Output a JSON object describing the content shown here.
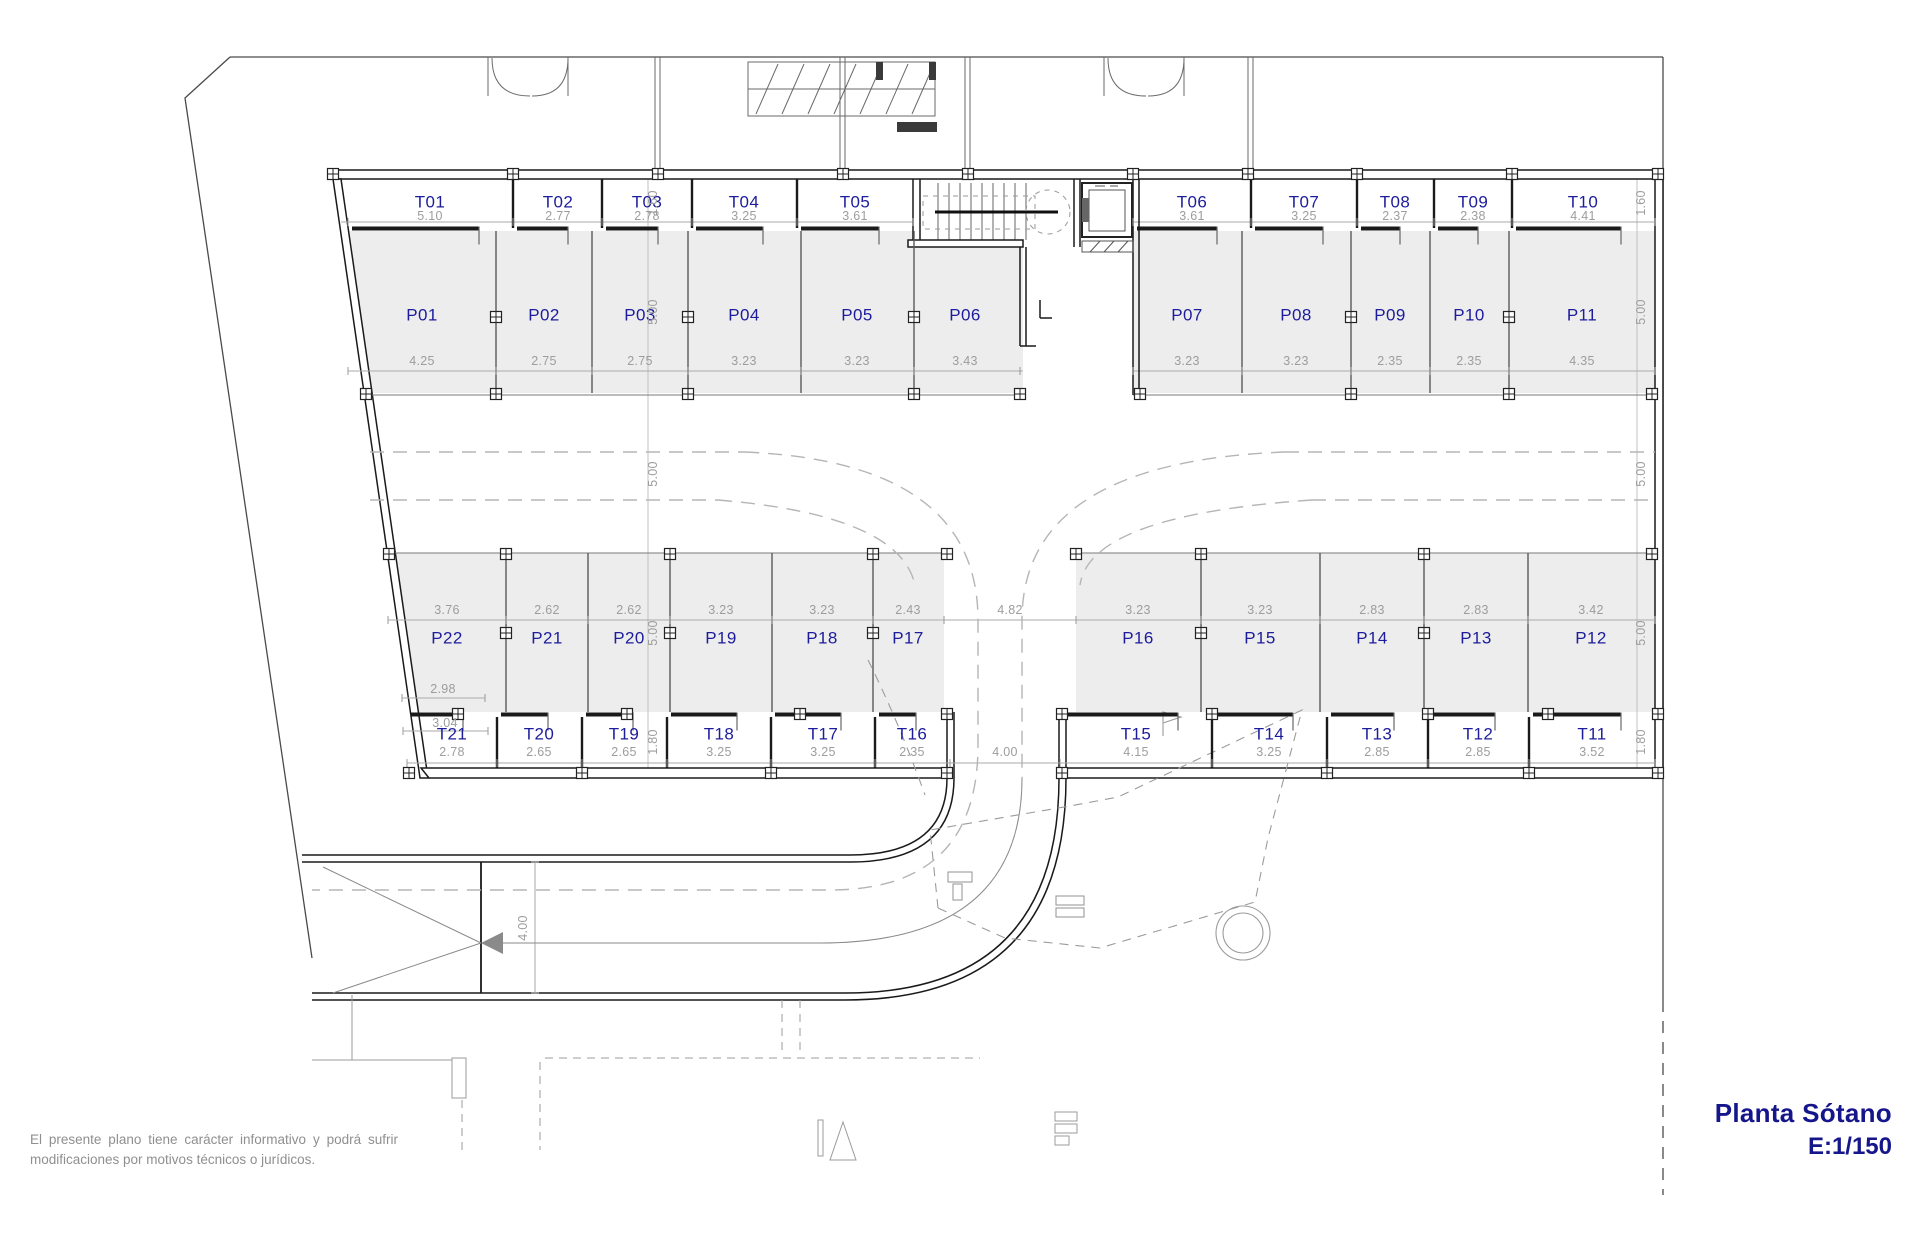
{
  "page": {
    "title": "Planta Sótano",
    "scale": "E:1/150"
  },
  "disclaimer": {
    "line1": "El presente plano tiene carácter informativo y podrá sufrir",
    "line2": "modificaciones por motivos técnicos o jurídicos."
  },
  "colors": {
    "room_label": "#1c1c9c",
    "dim_label": "#9d9d9d",
    "title": "#16168c",
    "stall_fill": "#ededed",
    "wall": "#1a1a1a"
  },
  "rooms": [
    {
      "group": "storage-top",
      "label_y": 202,
      "dim_y": 216,
      "items": [
        {
          "id": "T01",
          "dim": "5.10",
          "cx": 430
        },
        {
          "id": "T02",
          "dim": "2.77",
          "cx": 558
        },
        {
          "id": "T03",
          "dim": "2.78",
          "cx": 647
        },
        {
          "id": "T04",
          "dim": "3.25",
          "cx": 744
        },
        {
          "id": "T05",
          "dim": "3.61",
          "cx": 855
        },
        {
          "id": "T06",
          "dim": "3.61",
          "cx": 1192
        },
        {
          "id": "T07",
          "dim": "3.25",
          "cx": 1304
        },
        {
          "id": "T08",
          "dim": "2.37",
          "cx": 1395
        },
        {
          "id": "T09",
          "dim": "2.38",
          "cx": 1473
        },
        {
          "id": "T10",
          "dim": "4.41",
          "cx": 1583
        }
      ]
    },
    {
      "group": "parking-top",
      "label_y": 315,
      "dim_y": 361,
      "items": [
        {
          "id": "P01",
          "dim": "4.25",
          "cx": 422
        },
        {
          "id": "P02",
          "dim": "2.75",
          "cx": 544
        },
        {
          "id": "P03",
          "dim": "2.75",
          "cx": 640
        },
        {
          "id": "P04",
          "dim": "3.23",
          "cx": 744
        },
        {
          "id": "P05",
          "dim": "3.23",
          "cx": 857
        },
        {
          "id": "P06",
          "dim": "3.43",
          "cx": 965
        },
        {
          "id": "P07",
          "dim": "3.23",
          "cx": 1187
        },
        {
          "id": "P08",
          "dim": "3.23",
          "cx": 1296
        },
        {
          "id": "P09",
          "dim": "2.35",
          "cx": 1390
        },
        {
          "id": "P10",
          "dim": "2.35",
          "cx": 1469
        },
        {
          "id": "P11",
          "dim": "4.35",
          "cx": 1582
        }
      ]
    },
    {
      "group": "parking-bottom",
      "label_y": 638,
      "dim_y": 610,
      "items": [
        {
          "id": "P22",
          "dim": "3.76",
          "cx": 447
        },
        {
          "id": "P21",
          "dim": "2.62",
          "cx": 547
        },
        {
          "id": "P20",
          "dim": "2.62",
          "cx": 629
        },
        {
          "id": "P19",
          "dim": "3.23",
          "cx": 721
        },
        {
          "id": "P18",
          "dim": "3.23",
          "cx": 822
        },
        {
          "id": "P17",
          "dim": "2.43",
          "cx": 908
        },
        {
          "id": "P16",
          "dim": "3.23",
          "cx": 1138
        },
        {
          "id": "P15",
          "dim": "3.23",
          "cx": 1260
        },
        {
          "id": "P14",
          "dim": "2.83",
          "cx": 1372
        },
        {
          "id": "P13",
          "dim": "2.83",
          "cx": 1476
        },
        {
          "id": "P12",
          "dim": "3.42",
          "cx": 1591
        }
      ]
    },
    {
      "group": "storage-bottom",
      "label_y": 734,
      "dim_y": 752,
      "items": [
        {
          "id": "T21",
          "dim": "2.78",
          "cx": 452
        },
        {
          "id": "T20",
          "dim": "2.65",
          "cx": 539
        },
        {
          "id": "T19",
          "dim": "2.65",
          "cx": 624
        },
        {
          "id": "T18",
          "dim": "3.25",
          "cx": 719
        },
        {
          "id": "T17",
          "dim": "3.25",
          "cx": 823
        },
        {
          "id": "T16",
          "dim": "2.35",
          "cx": 912
        },
        {
          "id": "T15",
          "dim": "4.15",
          "cx": 1136
        },
        {
          "id": "T14",
          "dim": "3.25",
          "cx": 1269
        },
        {
          "id": "T13",
          "dim": "2.85",
          "cx": 1377
        },
        {
          "id": "T12",
          "dim": "2.85",
          "cx": 1478
        },
        {
          "id": "T11",
          "dim": "3.52",
          "cx": 1592
        }
      ]
    }
  ],
  "extra_dims": [
    {
      "text": "4.82",
      "x": 1010,
      "y": 610,
      "rot": 0
    },
    {
      "text": "4.00",
      "x": 1005,
      "y": 752,
      "rot": 0
    },
    {
      "text": "2.98",
      "x": 443,
      "y": 689,
      "rot": 0
    },
    {
      "text": "3.04",
      "x": 445,
      "y": 723,
      "rot": 0
    },
    {
      "text": "1.60",
      "x": 653,
      "y": 203,
      "rot": 1
    },
    {
      "text": "5.00",
      "x": 653,
      "y": 312,
      "rot": 1
    },
    {
      "text": "5.00",
      "x": 653,
      "y": 474,
      "rot": 1
    },
    {
      "text": "5.00",
      "x": 653,
      "y": 633,
      "rot": 1
    },
    {
      "text": "1.80",
      "x": 653,
      "y": 742,
      "rot": 1
    },
    {
      "text": "1.60",
      "x": 1641,
      "y": 203,
      "rot": 1
    },
    {
      "text": "5.00",
      "x": 1641,
      "y": 312,
      "rot": 1
    },
    {
      "text": "5.00",
      "x": 1641,
      "y": 474,
      "rot": 1
    },
    {
      "text": "5.00",
      "x": 1641,
      "y": 633,
      "rot": 1
    },
    {
      "text": "1.80",
      "x": 1641,
      "y": 742,
      "rot": 1
    },
    {
      "text": "4.00",
      "x": 523,
      "y": 928,
      "rot": 1
    }
  ]
}
